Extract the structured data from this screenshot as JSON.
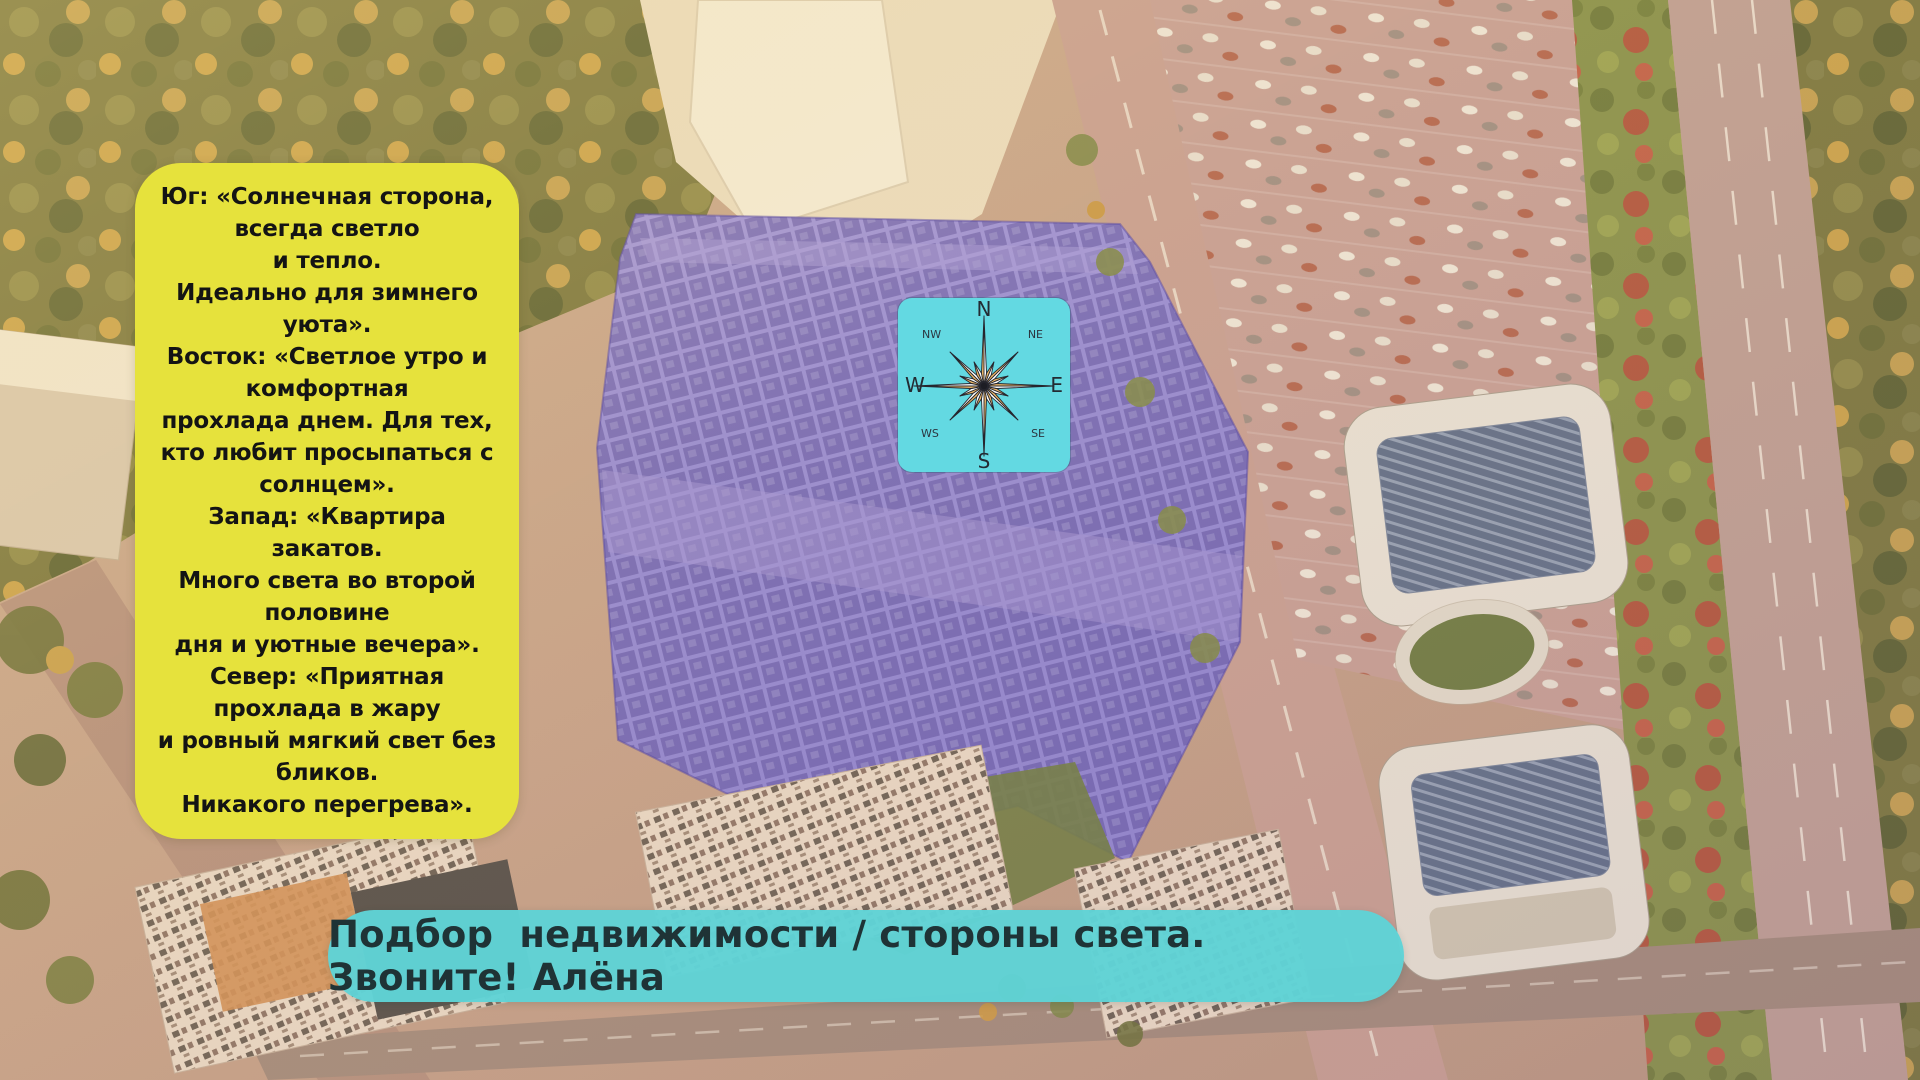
{
  "poster": {
    "language": "ru",
    "accent_colors": {
      "card_yellow": "#e6e23c",
      "banner_cyan": "#5fd3d6",
      "compass_cyan": "#63d9e2",
      "building_highlight_purple": "#7569c2",
      "rose_orange": "#eab667",
      "rose_white": "#ffffff"
    }
  },
  "info_card": {
    "lines": [
      "Юг: «Солнечная сторона,",
      "всегда светло",
      "и тепло.",
      "Идеально для зимнего",
      "уюта».",
      "Восток: «Светлое утро и",
      "комфортная",
      "прохлада днем. Для тех,",
      "кто любит просыпаться с",
      "солнцем».",
      "Запад: «Квартира закатов.",
      "Много света во второй",
      "половине",
      "дня и уютные вечера».",
      "Север: «Приятная",
      "прохлада в жару",
      "и ровный мягкий свет без",
      "бликов.",
      "Никакого перегрева»."
    ]
  },
  "compass": {
    "labels": {
      "n": "N",
      "ne": "NE",
      "e": "E",
      "se": "SE",
      "s": "S",
      "ws": "WS",
      "w": "W",
      "nw": "NW"
    }
  },
  "banner": {
    "text": "Подбор  недвижимости / стороны света. Звоните! Алёна"
  }
}
